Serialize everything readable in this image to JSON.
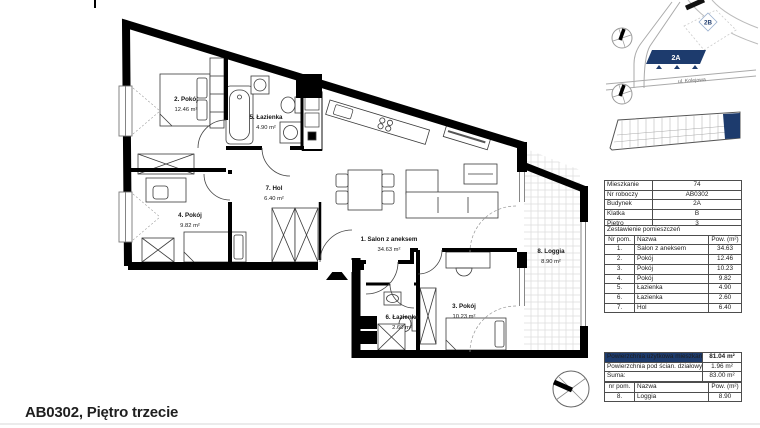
{
  "colors": {
    "navy": "#1d3b6d"
  },
  "plan": {
    "rooms": [
      {
        "label": "1. Salon z aneksem",
        "area": "34.63 m²"
      },
      {
        "label": "2. Pokój",
        "area": "12.46 m²"
      },
      {
        "label": "3. Pokój",
        "area": "10.23 m²"
      },
      {
        "label": "4. Pokój",
        "area": "9.82 m²"
      },
      {
        "label": "5. Łazienka",
        "area": "4.90 m²"
      },
      {
        "label": "6. Łazienka",
        "area": "2.60 m²"
      },
      {
        "label": "7. Hol",
        "area": "6.40 m²"
      },
      {
        "label": "8. Loggia",
        "area": "8.90 m²"
      }
    ]
  },
  "site_map": {
    "building_2b": "2B",
    "building_2a": "2A",
    "street": "ul. Kolejowa"
  },
  "info_table": {
    "rows": [
      {
        "label": "Mieszkanie",
        "value": "74"
      },
      {
        "label": "Nr roboczy",
        "value": "AB0302"
      },
      {
        "label": "Budynek",
        "value": "2A"
      },
      {
        "label": "Klatka",
        "value": "B"
      },
      {
        "label": "Piętro",
        "value": "3"
      }
    ]
  },
  "rooms_table": {
    "title": "Zestawienie pomieszczeń",
    "headers": {
      "nr": "Nr pom.",
      "name": "Nazwa",
      "area": "Pow. (m²)"
    },
    "rows": [
      {
        "nr": "1.",
        "name": "Salon z aneksem",
        "area": "34.63"
      },
      {
        "nr": "2.",
        "name": "Pokój",
        "area": "12.46"
      },
      {
        "nr": "3.",
        "name": "Pokój",
        "area": "10.23"
      },
      {
        "nr": "4.",
        "name": "Pokój",
        "area": "9.82"
      },
      {
        "nr": "5.",
        "name": "Łazienka",
        "area": "4.90"
      },
      {
        "nr": "6.",
        "name": "Łazienka",
        "area": "2.60"
      },
      {
        "nr": "7.",
        "name": "Hol",
        "area": "6.40"
      }
    ]
  },
  "summary_table": {
    "rows": [
      {
        "label": "Powierzchnia użytkowa mieszkania",
        "value": "81.04 m²"
      },
      {
        "label": "Powierzchnia pod ścian. działowymi",
        "value": "1.96 m²"
      },
      {
        "label": "Suma:",
        "value": "83.00 m²"
      }
    ]
  },
  "loggia_table": {
    "headers": {
      "nr": "nr pom.",
      "name": "Nazwa",
      "area": "Pow. (m²)"
    },
    "rows": [
      {
        "nr": "8.",
        "name": "Loggia",
        "area": "8.90"
      }
    ]
  },
  "footer": {
    "title": "AB0302, Piętro trzecie"
  }
}
